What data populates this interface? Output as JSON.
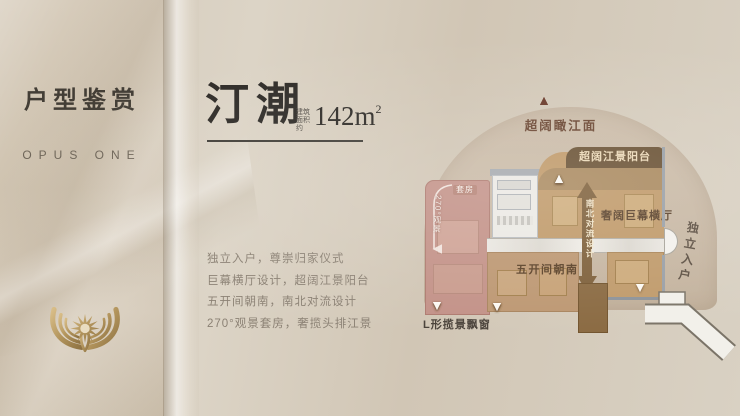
{
  "left_panel": {
    "title": "户型鉴赏",
    "subtitle": "OPUS ONE"
  },
  "hero": {
    "name": "汀潮",
    "area_prefix_line1": "建筑",
    "area_prefix_line2": "面积约",
    "area_value": "142m",
    "area_sup": "2"
  },
  "features": [
    "独立入户，尊崇归家仪式",
    "巨幕横厅设计，超阔江景阳台",
    "五开间朝南，南北对流设计",
    "270°观景套房，奢揽头排江景"
  ],
  "floorplan": {
    "river_view_label": "超阔瞰江面",
    "balcony_label": "超阔江景阳台",
    "living_label": "奢阔巨幕横厅",
    "flow_label": "南北对流设计",
    "south_label": "五开间朝南",
    "suite_label": "套房",
    "suite_view_label": "270°观景",
    "entry_label": "独立入户",
    "bay_window_label": "L形揽景飘窗"
  },
  "colors": {
    "background_beige": "#d6ccbc",
    "dome_beige": "#c9b9a5",
    "banner_brown": "#6b5336",
    "living_tan": "#c09a6a",
    "balcony_tan": "#aa8a60",
    "suite_pink": "#c39288",
    "flow_arrow_brown": "#7f613c",
    "label_brown": "#5a4128",
    "emblem_gold": "#b2945c",
    "headline_ink": "#2f2c28",
    "feature_gray": "#8b8174"
  }
}
